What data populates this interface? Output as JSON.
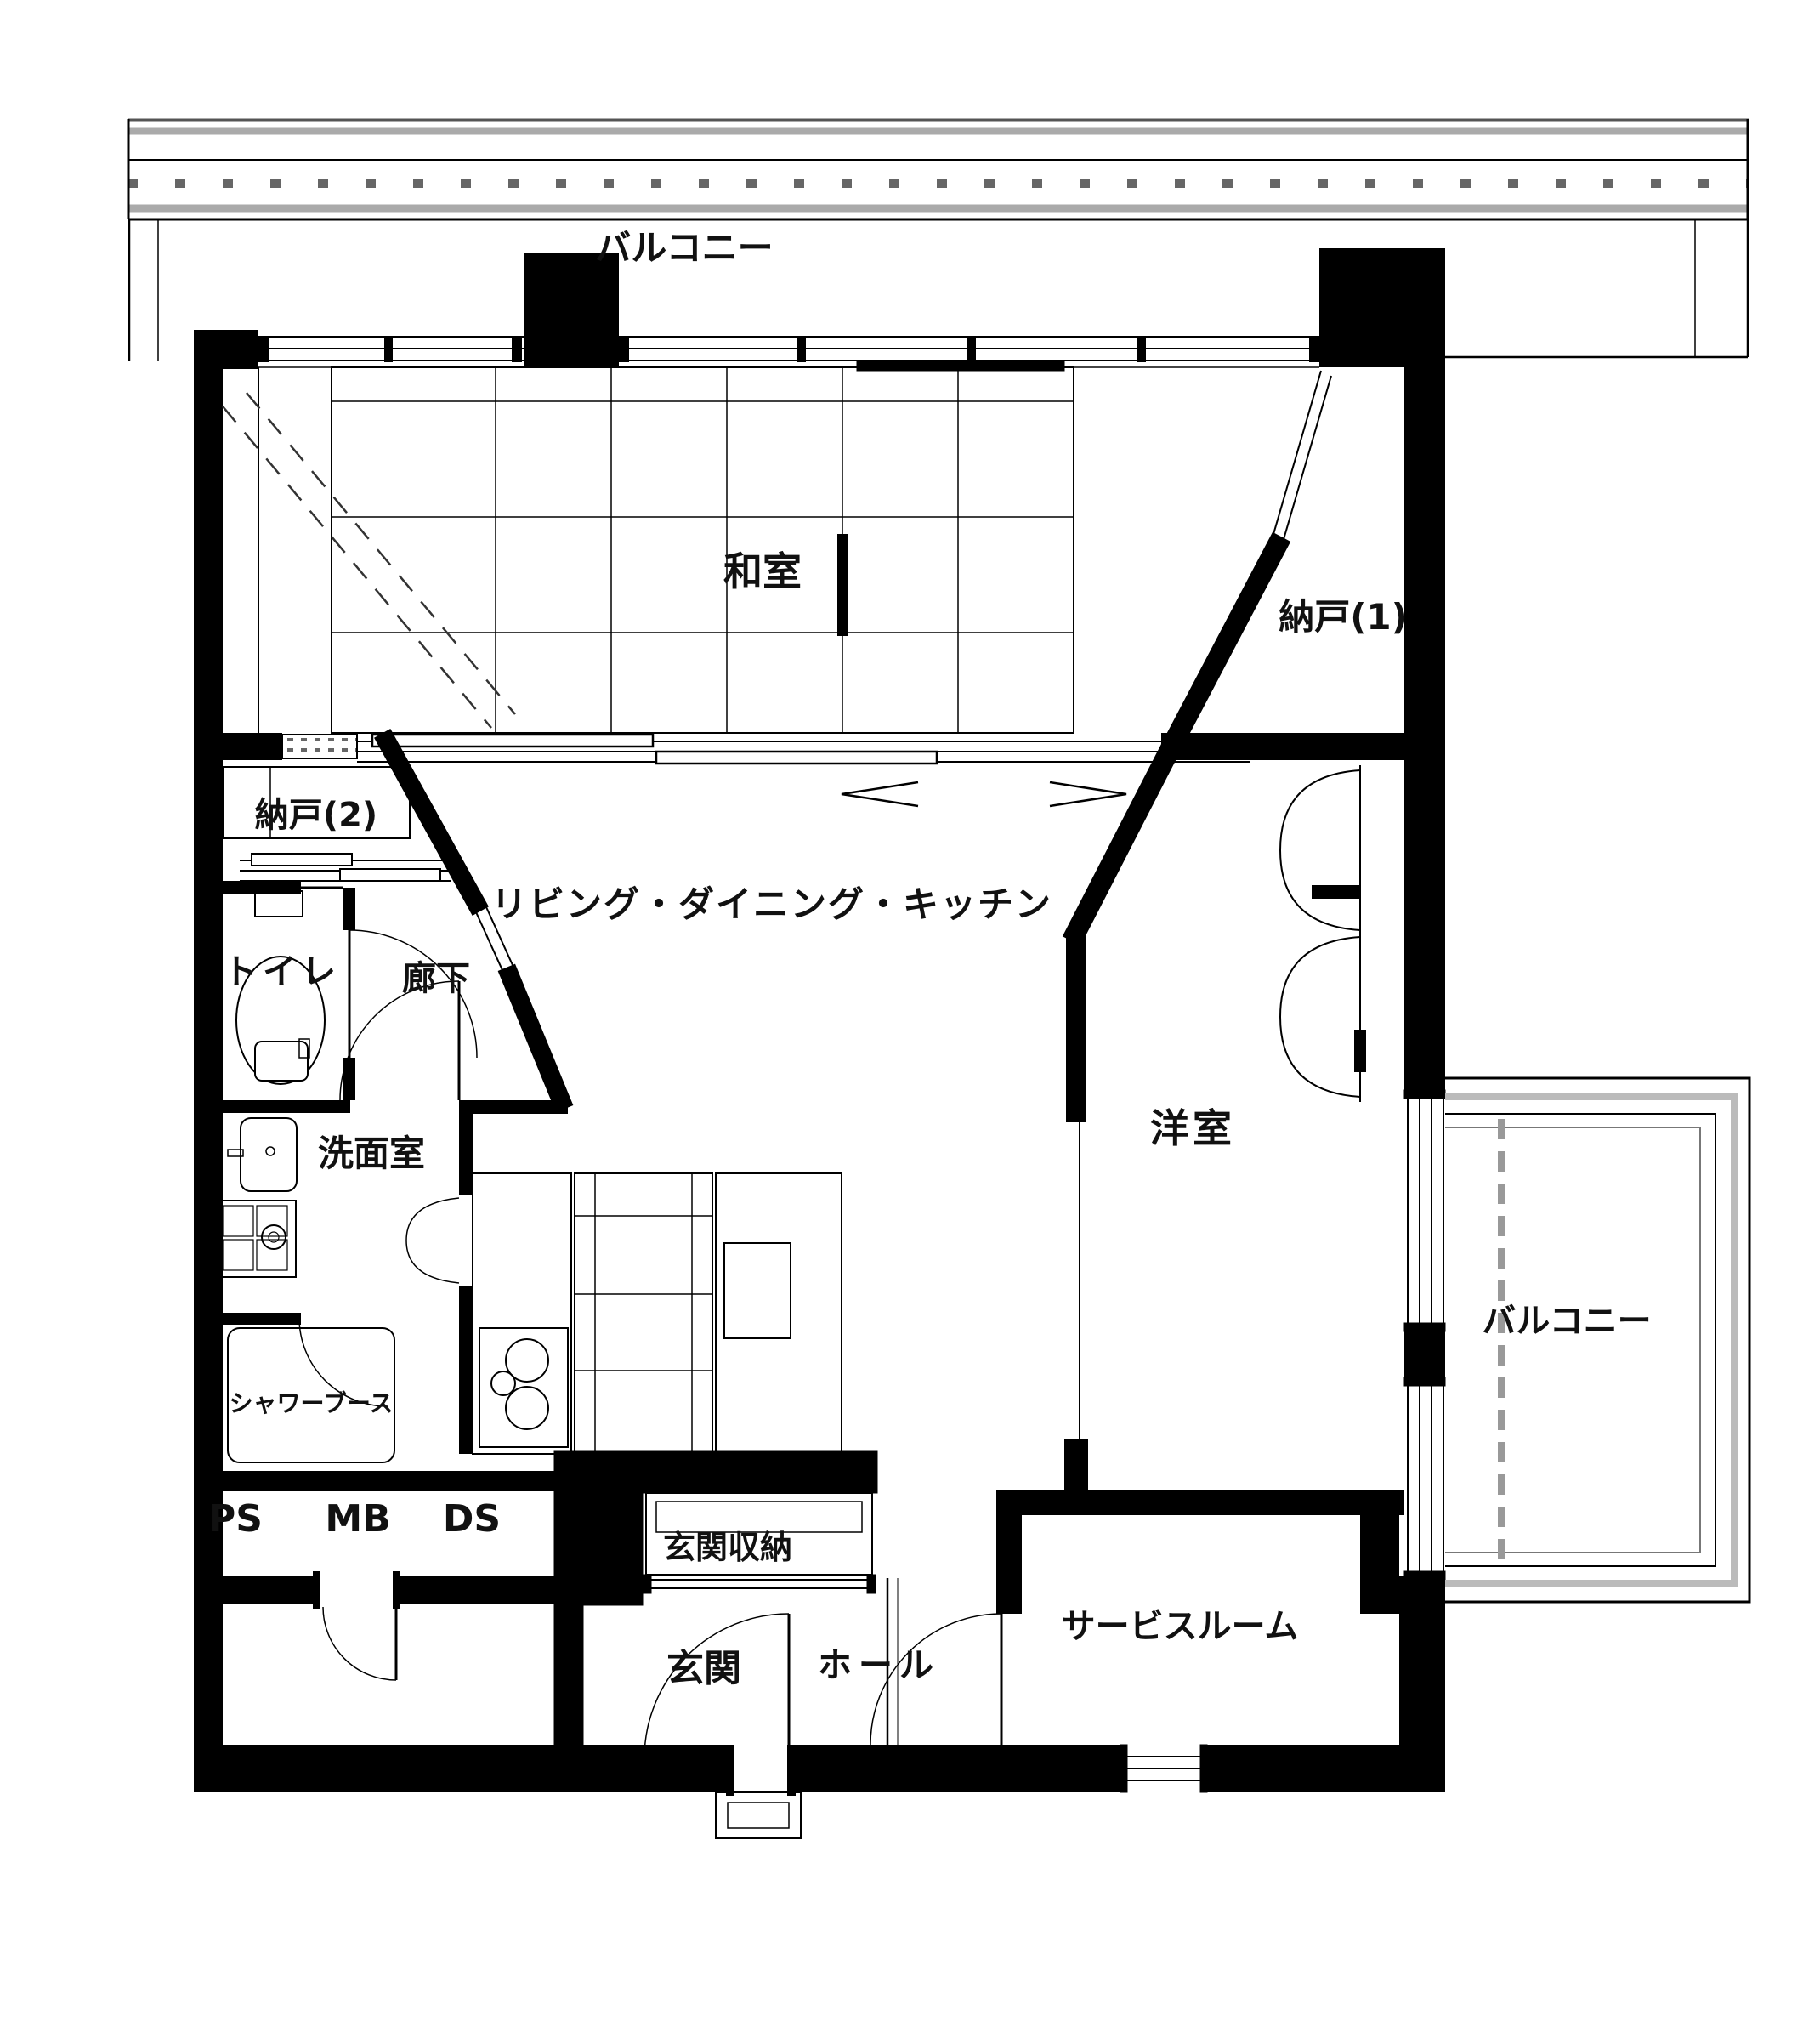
{
  "plan": {
    "type": "apartment-floor-plan",
    "colors": {
      "wall": "#000000",
      "rail_gray": "#aaaaaa",
      "hatch_gray": "#666666",
      "background": "#ffffff"
    },
    "rooms": [
      {
        "id": "balcony-top",
        "label": "バルコニー"
      },
      {
        "id": "washitsu",
        "label": "和室"
      },
      {
        "id": "nando-1",
        "label": "納戸(1)"
      },
      {
        "id": "nando-2",
        "label": "納戸(2)"
      },
      {
        "id": "toilet",
        "label": "トイレ"
      },
      {
        "id": "corridor",
        "label": "廊下"
      },
      {
        "id": "ldk",
        "label": "リビング・ダイニング・キッチン"
      },
      {
        "id": "senmenshitsu",
        "label": "洗面室"
      },
      {
        "id": "youshitsu",
        "label": "洋室"
      },
      {
        "id": "shower-booth",
        "label": "シャワーブース"
      },
      {
        "id": "balcony-right",
        "label": "バルコニー"
      },
      {
        "id": "ps",
        "label": "PS"
      },
      {
        "id": "mb",
        "label": "MB"
      },
      {
        "id": "ds",
        "label": "DS"
      },
      {
        "id": "genkan-storage",
        "label": "玄関収納"
      },
      {
        "id": "genkan",
        "label": "玄関"
      },
      {
        "id": "hall",
        "label": "ホール"
      },
      {
        "id": "service-room",
        "label": "サービスルーム"
      }
    ],
    "fixtures": [
      "toilet-icon",
      "vanity-sink-icon",
      "washing-machine-pan-icon",
      "stove-burners-icon",
      "kitchen-sink-icon",
      "tatami-grid",
      "sliding-door-track",
      "closet-double-doors",
      "door-swing-arc",
      "balcony-railing",
      "entrance-step"
    ]
  }
}
